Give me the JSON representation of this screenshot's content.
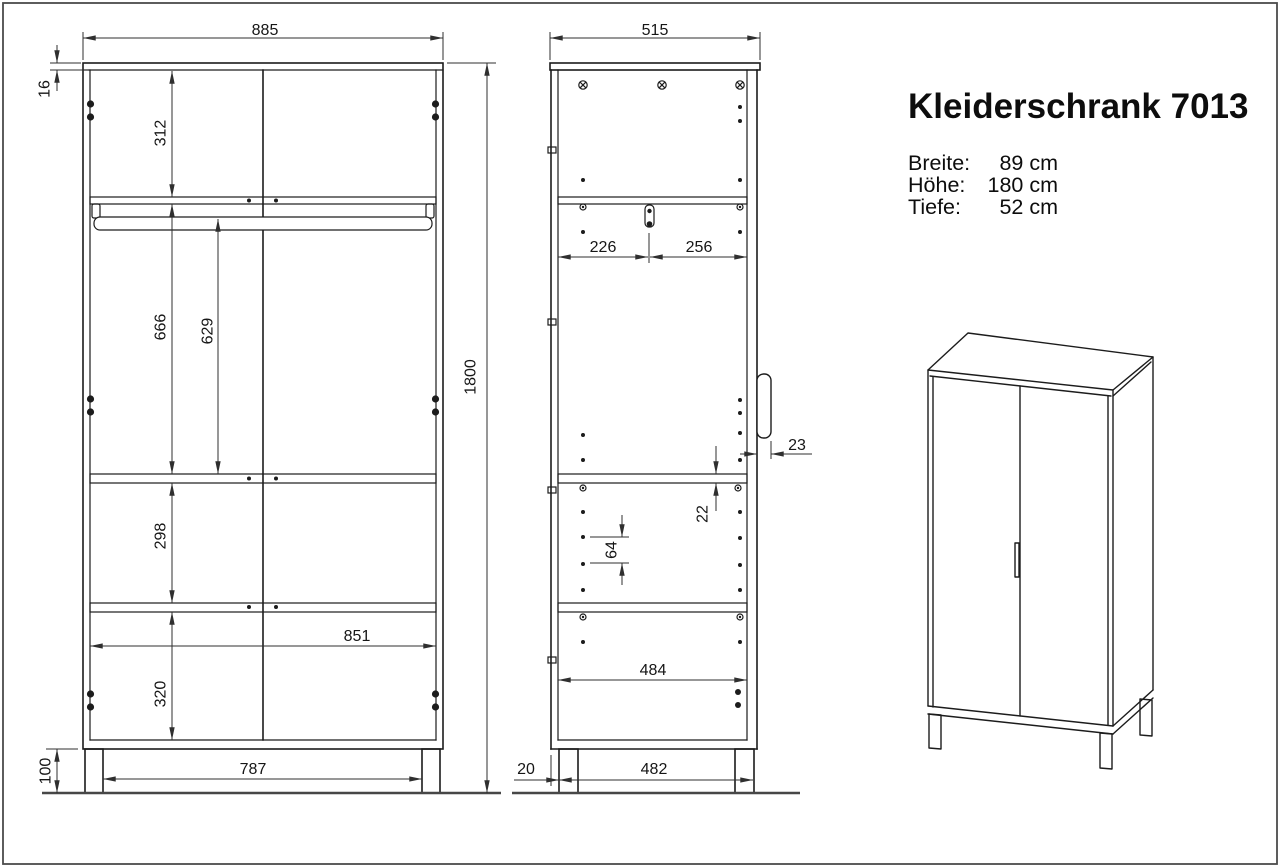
{
  "title": "Kleiderschrank 7013",
  "specs": {
    "rows": [
      {
        "label": "Breite:",
        "value": "89 cm"
      },
      {
        "label": "Höhe:",
        "value": "180 cm"
      },
      {
        "label": "Tiefe:",
        "value": "52 cm"
      }
    ]
  },
  "front_view": {
    "dims": {
      "width": "885",
      "top_panel": "16",
      "top_section": "312",
      "middle_section": "666",
      "rail_height": "629",
      "shelf_section": "298",
      "bottom_section": "320",
      "interior_width": "851",
      "height": "1800",
      "plinth_height": "100",
      "plinth_width": "787"
    }
  },
  "side_view": {
    "dims": {
      "depth": "515",
      "rail_to_back": "226",
      "rail_to_front": "256",
      "handle_depth": "23",
      "shelf_thickness": "22",
      "hole_pitch": "64",
      "interior_depth": "484",
      "back_inset": "20",
      "plinth_depth": "482"
    }
  }
}
